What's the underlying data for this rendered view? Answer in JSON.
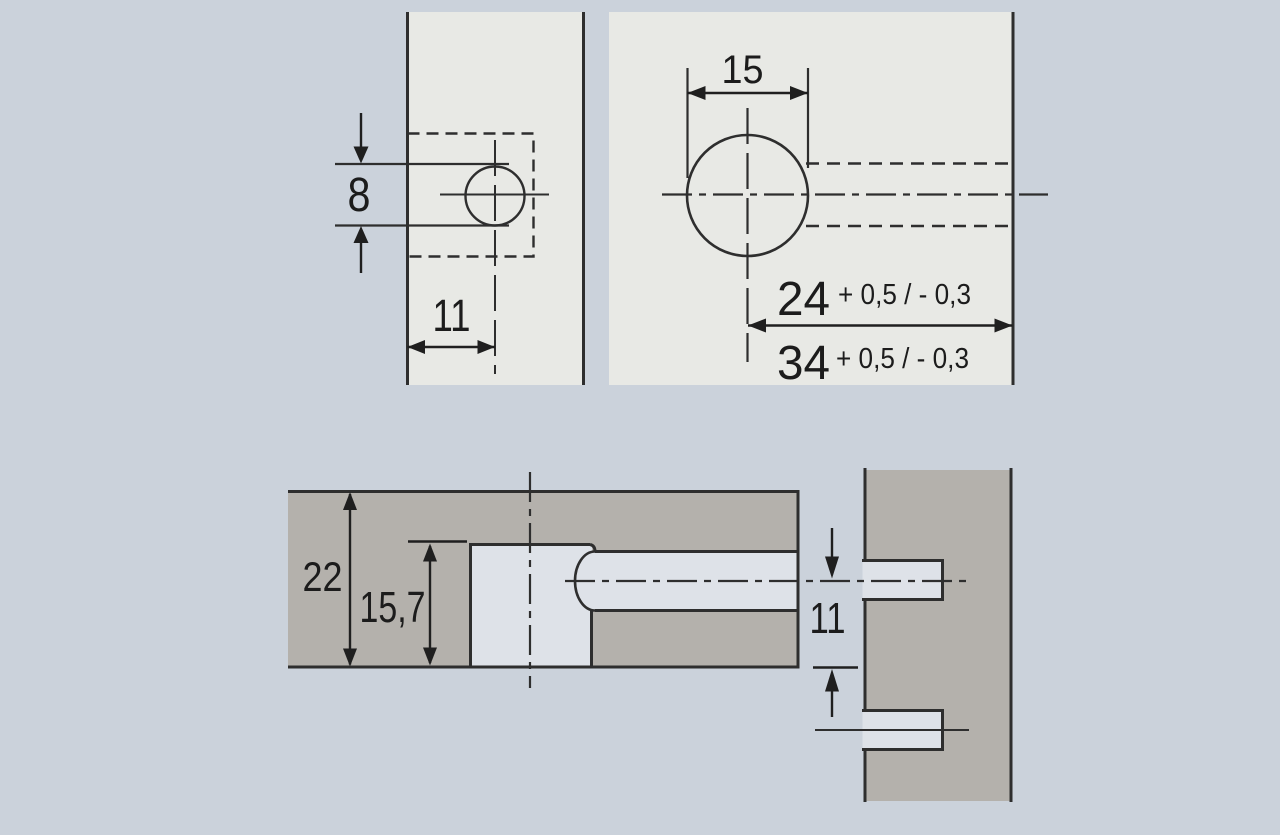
{
  "labels": {
    "side_view": {
      "hole_diameter": "8",
      "edge_distance": "11"
    },
    "face_view": {
      "hole_diameter": "15",
      "distance_a": "24",
      "tolerance_a": "+ 0,5 / - 0,3",
      "distance_b": "34",
      "tolerance_b": "+ 0,5 / - 0,3"
    },
    "section_view": {
      "panel_thickness": "22",
      "drill_height": "15,7",
      "axis_offset": "11"
    }
  },
  "colors": {
    "background": "#cbd2db",
    "panel_light": "#e8e9e5",
    "panel_dark": "#b4b1ac",
    "hole_white": "#f6f7f4",
    "cut_white": "#dee2e8",
    "line": "#2e2e2e",
    "dim": "#1f1f1f"
  }
}
